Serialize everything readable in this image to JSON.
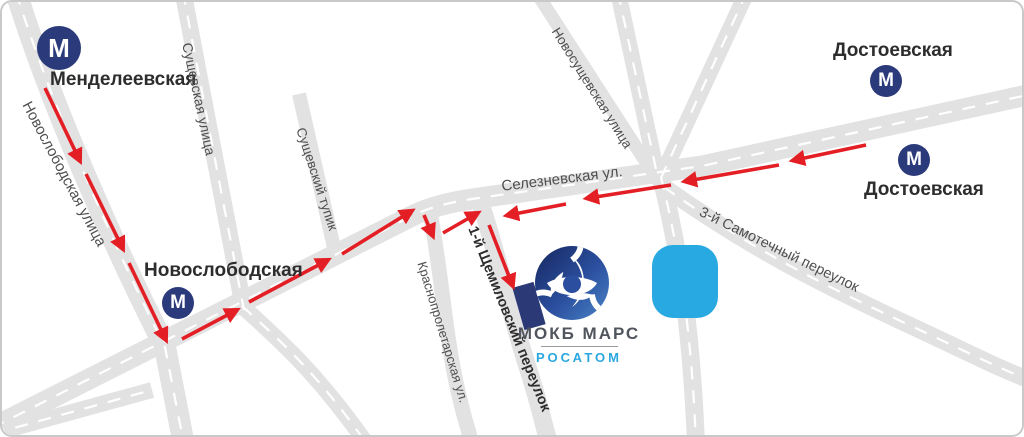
{
  "metro": {
    "symbol": "М"
  },
  "stations": [
    {
      "name": "Менделеевская"
    },
    {
      "name": "Новослободская"
    },
    {
      "name": "Достоевская"
    },
    {
      "name": "Достоевская"
    }
  ],
  "streets": {
    "novoslobodskaya": "Новослободская улица",
    "sushchevskaya": "Сущевская улица",
    "sushchevskiy_tupik": "Сущевский тупик",
    "seleznevskaya": "Селезневская ул.",
    "novosushchevskaya": "Новосущевская улица",
    "krasnoproletarskaya": "Краснопролетарская ул.",
    "shchemilovskiy": "1-й Щемиловский переулок",
    "samotechny": "3-й Самотечный переулок"
  },
  "organization": {
    "name": "МОКБ МАРС",
    "brand": "РОСАТОМ"
  },
  "colors": {
    "road": "#e2e2e2",
    "route_arrow": "#e31e24",
    "metro_blue": "#2b3a7a",
    "rosatom_blue": "#2ba7e0",
    "building_navy": "#2b3a76",
    "landmark_blue": "#29a9e1",
    "street_label": "#4f4f4f"
  }
}
